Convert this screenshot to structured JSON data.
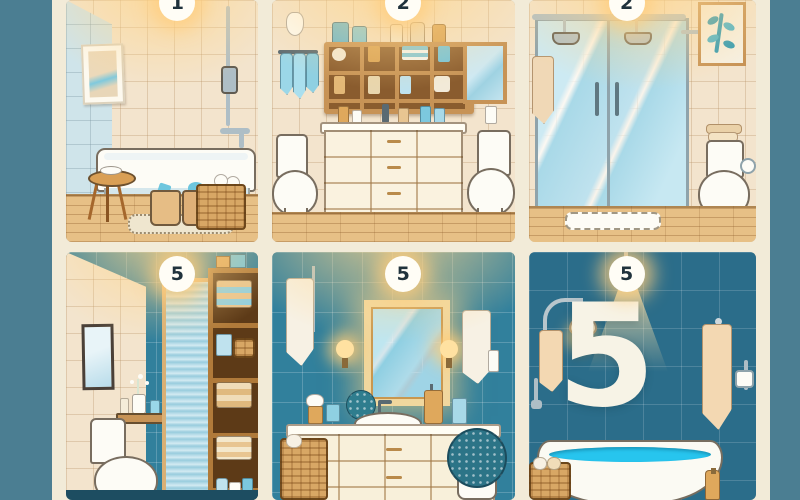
{
  "poster": {
    "title": "bathroom styles illustration grid",
    "rows": 2,
    "columns": 3,
    "palette": {
      "background_teal": "#4b7e92",
      "gutter_cream": "#f2ebd8",
      "beige_tile": "#f3e4cd",
      "teal_tile": "#31809c",
      "dark_teal_tile": "#2b6d8a",
      "wood_floor": "#e7c086",
      "glass_blue": "#bfe2ee",
      "towel_blue": "#9bd7e8",
      "towel_peach": "#f3d8b2",
      "water_cyan": "#27c5ee",
      "furniture_cream": "#f8f0da",
      "wicker_tan": "#d8a765",
      "glow_amber": "#ffd68c"
    }
  },
  "panels": [
    {
      "badge": "1",
      "scene": "bathtub room",
      "items": [
        "ceiling-light-glow",
        "wall-art",
        "shower-rail",
        "tub-faucet",
        "bathtub",
        "wooden-stool",
        "storage-canisters",
        "wicker-basket-towels",
        "bath-rug",
        "wood-floor"
      ]
    },
    {
      "badge": "2",
      "scene": "storage wall with dresser and twin toilets",
      "items": [
        "cubby-shelf",
        "shelf-bottles",
        "hanging-blue-towels",
        "robe-hook",
        "wall-mirror",
        "dresser-vanity",
        "counter-toiletries",
        "toilet-left",
        "toilet-right",
        "wood-floor"
      ]
    },
    {
      "badge": "2",
      "scene": "glass walk-in shower",
      "items": [
        "glass-enclosure",
        "shower-heads",
        "door-handles",
        "hanging-towel",
        "leaf-wall-art",
        "toilet-with-towel-stack",
        "toilet-paper-holder",
        "bath-mat",
        "wood-floor"
      ]
    },
    {
      "badge": "5",
      "scene": "toilet nook with frosted door and linen tower",
      "items": [
        "wall-mirror",
        "floating-shelf",
        "flower-vase",
        "toilet",
        "frosted-glass-door",
        "linen-shelf-tower",
        "folded-towels",
        "toiletry-bottles"
      ]
    },
    {
      "badge": "5",
      "scene": "vanity with lit mirror and sconces",
      "items": [
        "framed-lit-mirror",
        "wall-sconces",
        "hanging-towels",
        "shower-rail",
        "sink-vanity",
        "counter-toiletries",
        "soap-pump",
        "topiary-ball",
        "wicker-hamper",
        "potted-topiary"
      ]
    },
    {
      "badge": "5",
      "wall_number": "5",
      "scene": "freestanding tub under spotlight",
      "items": [
        "ceiling-spotlight",
        "wall-lamp",
        "hanging-towel-left",
        "hanging-towel-right",
        "toilet-paper-holder",
        "freestanding-bathtub",
        "water",
        "wicker-basket",
        "amber-bottle"
      ]
    }
  ]
}
